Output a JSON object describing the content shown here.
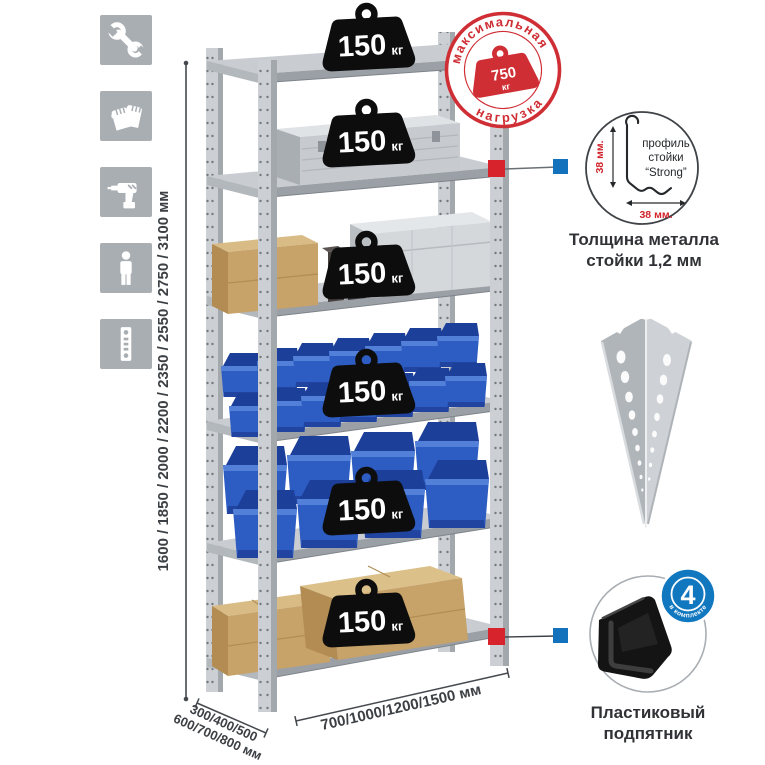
{
  "colors": {
    "accent_red": "#d0232b",
    "accent_blue": "#1472bd",
    "stamp_red": "#cf2e35",
    "metal_gray": "#ccd0d4",
    "bin_blue": "#2d5cc3",
    "badge_black": "#0d0d0d",
    "icon_square_gray": "#a9aeb3"
  },
  "sidebar_icons": [
    {
      "name": "wrench-icon"
    },
    {
      "name": "gloves-icon"
    },
    {
      "name": "drill-icon"
    },
    {
      "name": "person-icon"
    },
    {
      "name": "upright-icon"
    }
  ],
  "dimensions": {
    "height": "1600 / 1850 / 2000 / 2200 / 2350 / 2550 / 2750 / 3100 мм",
    "depth_line1": "300/400/500",
    "depth_line2": "600/700/800 мм",
    "width": "700/1000/1200/1500 мм"
  },
  "rack": {
    "load_value": "150",
    "load_unit": "кг"
  },
  "stamp": {
    "arc_top": "максимальная",
    "arc_bottom": "нагрузка",
    "value": "750",
    "unit": "кг"
  },
  "profile": {
    "label1": "профиль",
    "label2": "стойки",
    "label3": "“Strong”",
    "dim_v": "38 мм.",
    "dim_h": "38 мм.",
    "caption1": "Толщина металла",
    "caption2": "стойки 1,2 мм"
  },
  "foot": {
    "badge_value": "4",
    "badge_arc": "в комплекте",
    "caption1": "Пластиковый",
    "caption2": "подпятник"
  }
}
